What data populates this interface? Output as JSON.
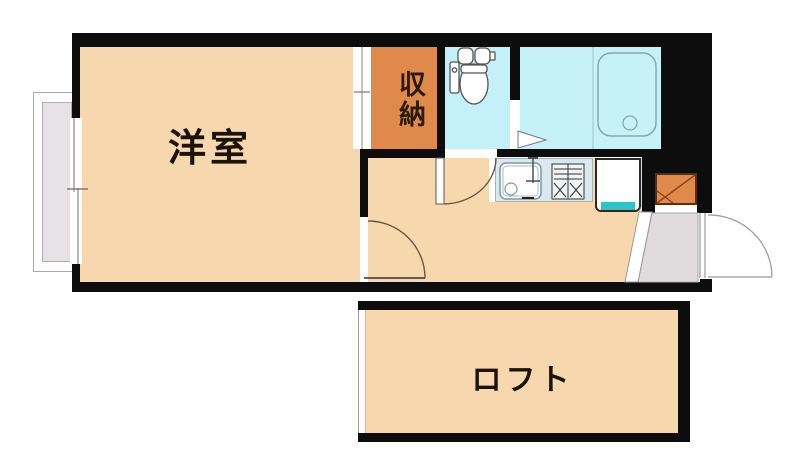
{
  "plan": {
    "type": "apartment-floor-plan",
    "labels": {
      "western_room": "洋室",
      "storage": "収納",
      "loft": "ロフト"
    },
    "colors": {
      "wall": "#0d0d0d",
      "room_peach": "#F7D8AE",
      "storage_orange": "#DF8A4B",
      "toilet_cyan": "#C3F0F9",
      "bath_cyan": "#C6F2F7",
      "counter_gray": "#DBE8ED",
      "entrance_gray": "#E0DBDD",
      "balcony_gray": "#E7E2E6",
      "laundry_teal": "#2CC4C7",
      "door_arc_brown": "#6e5640",
      "door_arc_gray": "#999999",
      "fixture_stroke": "#7e99a6"
    },
    "icons": [
      "toilet-icon",
      "bathtub-icon",
      "sink-icon",
      "stove-icon",
      "door-arc-icon",
      "sliding-window-icon",
      "shoe-cabinet-icon"
    ]
  }
}
